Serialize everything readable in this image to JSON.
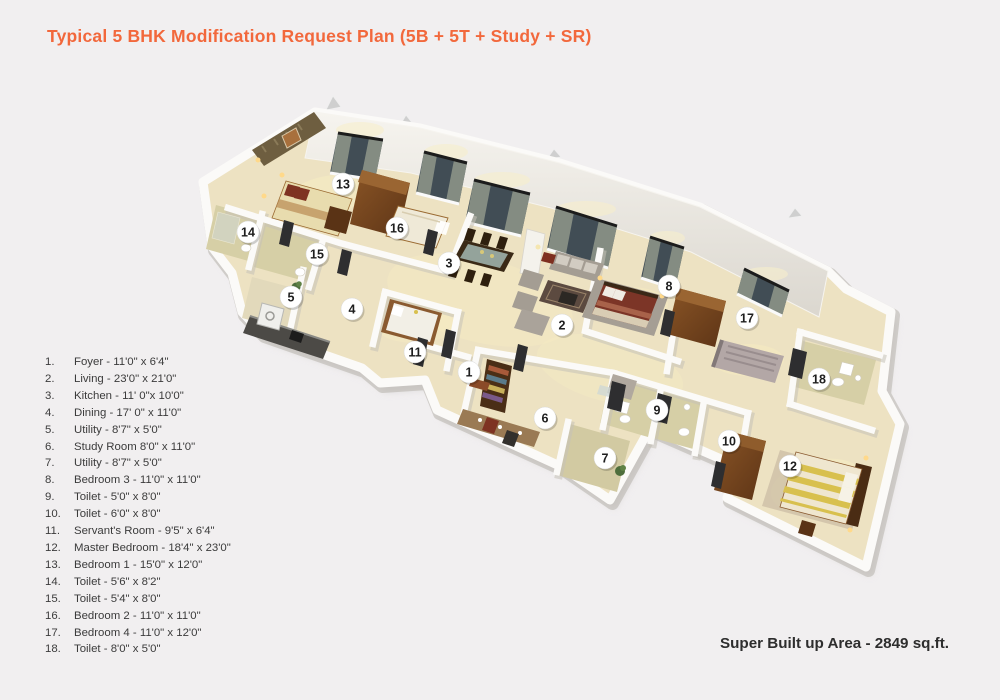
{
  "title": "Typical 5 BHK Modification Request Plan (5B + 5T + Study + SR)",
  "area_note": "Super Built up Area - 2849 sq.ft.",
  "colors": {
    "accent": "#f2683c",
    "ink": "#3b3b3b",
    "floor": "#ede2c2",
    "toilet_floor": "#d6cfa6",
    "wall": "#fbfaf8",
    "window_glass": "#414d55",
    "wood": "#6e4119",
    "marker_bg": "#ffffff",
    "marker_text": "#1e1e1e"
  },
  "legend": {
    "items": [
      {
        "no": "1.",
        "label": "Foyer - 11'0\" x 6'4\""
      },
      {
        "no": "2.",
        "label": "Living - 23'0\" x 21'0\""
      },
      {
        "no": "3.",
        "label": "Kitchen - 11' 0\"x 10'0\""
      },
      {
        "no": "4.",
        "label": "Dining - 17' 0\" x 11'0\""
      },
      {
        "no": "5.",
        "label": "Utility - 8'7\" x 5'0\""
      },
      {
        "no": "6.",
        "label": "Study Room 8'0\" x 11'0\""
      },
      {
        "no": "7.",
        "label": "Utility - 8'7\" x 5'0\""
      },
      {
        "no": "8.",
        "label": "Bedroom 3 - 11'0\" x 11'0\""
      },
      {
        "no": "9.",
        "label": "Toilet - 5'0\" x 8'0\""
      },
      {
        "no": "10.",
        "label": "Toilet - 6'0\" x 8'0\""
      },
      {
        "no": "11.",
        "label": "Servant's Room - 9'5\" x 6'4\""
      },
      {
        "no": "12.",
        "label": "Master Bedroom  - 18'4\" x 23'0\""
      },
      {
        "no": "13.",
        "label": "Bedroom 1 - 15'0\" x 12'0\""
      },
      {
        "no": "14.",
        "label": "Toilet - 5'6\" x 8'2\""
      },
      {
        "no": "15.",
        "label": "Toilet - 5'4\" x 8'0\""
      },
      {
        "no": "16.",
        "label": "Bedroom 2  - 11'0\" x 11'0\""
      },
      {
        "no": "17.",
        "label": "Bedroom 4  - 11'0\" x 12'0\""
      },
      {
        "no": "18.",
        "label": "Toilet - 8'0\" x 5'0\""
      }
    ]
  },
  "markers": [
    {
      "n": "1",
      "x": 469,
      "y": 372
    },
    {
      "n": "2",
      "x": 562,
      "y": 325
    },
    {
      "n": "3",
      "x": 449,
      "y": 263
    },
    {
      "n": "4",
      "x": 352,
      "y": 309
    },
    {
      "n": "5",
      "x": 291,
      "y": 297
    },
    {
      "n": "6",
      "x": 545,
      "y": 418
    },
    {
      "n": "7",
      "x": 605,
      "y": 458
    },
    {
      "n": "8",
      "x": 669,
      "y": 286
    },
    {
      "n": "9",
      "x": 657,
      "y": 410
    },
    {
      "n": "10",
      "x": 729,
      "y": 441
    },
    {
      "n": "11",
      "x": 415,
      "y": 352
    },
    {
      "n": "12",
      "x": 790,
      "y": 466
    },
    {
      "n": "13",
      "x": 343,
      "y": 184
    },
    {
      "n": "14",
      "x": 248,
      "y": 232
    },
    {
      "n": "15",
      "x": 317,
      "y": 254
    },
    {
      "n": "16",
      "x": 397,
      "y": 228
    },
    {
      "n": "17",
      "x": 747,
      "y": 318
    },
    {
      "n": "18",
      "x": 819,
      "y": 379
    }
  ]
}
